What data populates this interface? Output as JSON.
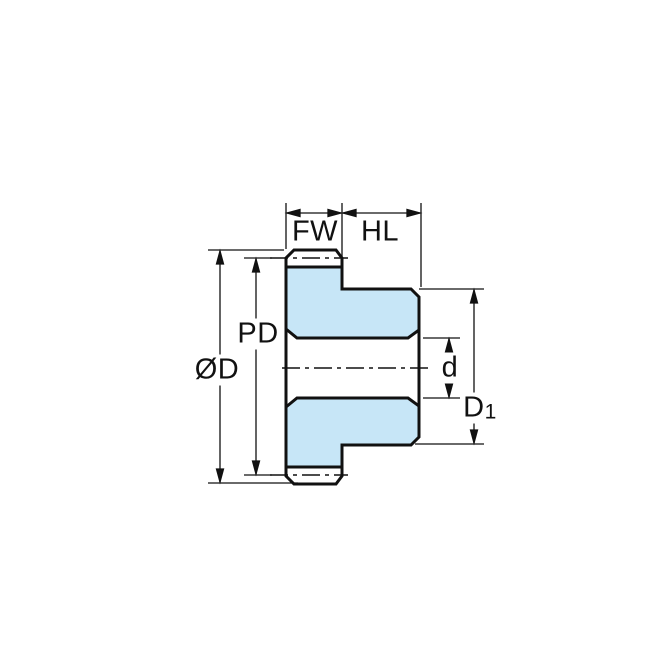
{
  "figure": {
    "description": "Dimensioned side cross-section drawing of a spur gear with hub",
    "colors": {
      "section_fill": "#c7e6f7",
      "line": "#111111",
      "background": "#ffffff"
    },
    "labels": {
      "face_width": "FW",
      "hub_length": "HL",
      "pitch_diameter": "PD",
      "outside_diameter": "ØD",
      "bore_diameter": "d",
      "hub_diameter": {
        "main": "D",
        "sub": "1"
      }
    }
  }
}
